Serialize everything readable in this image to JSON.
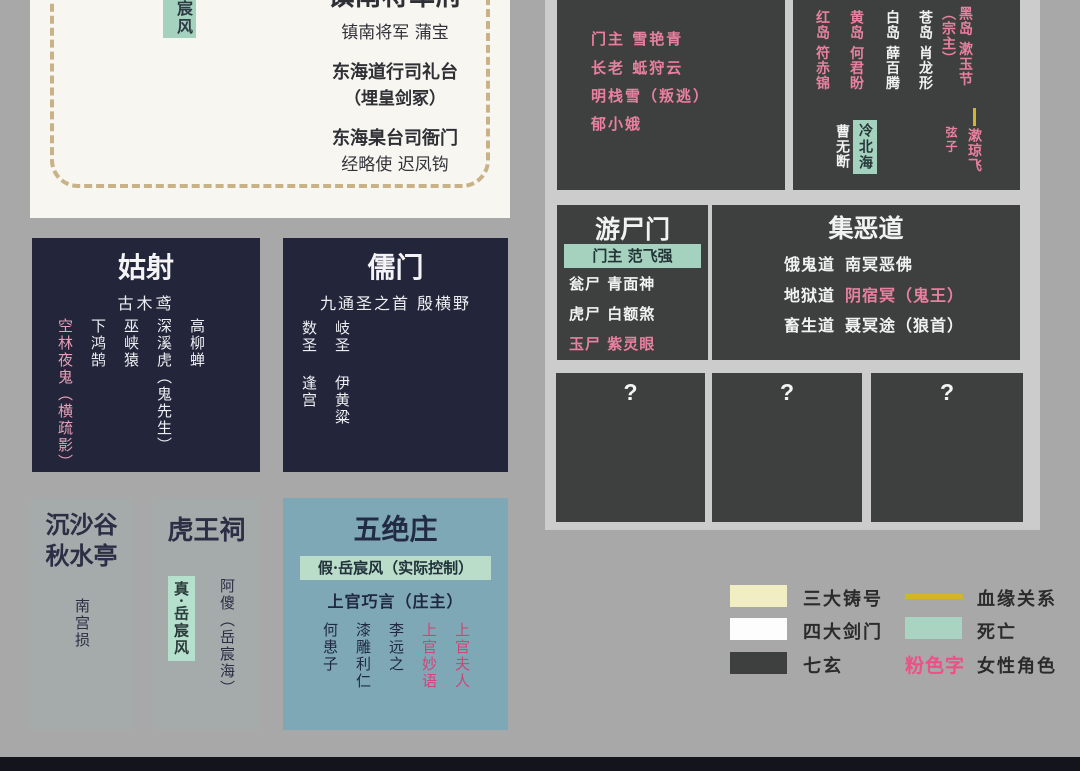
{
  "general_house": {
    "tag": "岳宸风",
    "title": "镇南将军府",
    "subtitle": "镇南将军  蒲宝",
    "entry2_title": "东海道行司礼台",
    "entry2_sub": "（埋皇剑冢）",
    "entry3_title": "东海臬台司衙门",
    "entry3_sub": "经略使  迟凤钩"
  },
  "haisha": {
    "title": "海沙会",
    "members": [
      "门主  雪艳青",
      "长老  蚳狩云",
      "明栈雪（叛逃）",
      "郁小娥"
    ]
  },
  "islands": {
    "columns": [
      "红岛 符赤锦",
      "黄岛 何君盼",
      "白岛 薛百腾",
      "苍岛 肖龙形",
      "黑岛 漱玉节（宗主）"
    ],
    "relation_label": "弦子",
    "descendant": "漱琼飞",
    "deceased": "冷北海",
    "extra": "曹无断"
  },
  "youshimen": {
    "title": "游尸门",
    "leader_line": "门主  范飞强",
    "members": [
      "瓮尸  青面神",
      "虎尸  白额煞",
      "玉尸  紫灵眼"
    ]
  },
  "jiedao": {
    "title": "集恶道",
    "rows": [
      {
        "prefix": "饿鬼道",
        "name": "南冥恶佛"
      },
      {
        "prefix": "地狱道",
        "name": "阴宿冥（鬼王）"
      },
      {
        "prefix": "畜生道",
        "name": "聂冥途（狼首）"
      }
    ]
  },
  "unknown_boxes": [
    "?",
    "?",
    "?"
  ],
  "gushe": {
    "title": "姑射",
    "leader": "古木鸢",
    "columns": [
      "高柳蝉",
      "深溪虎（鬼先生）",
      "巫峡猿",
      "下鸿鹄",
      "空林夜鬼（横疏影）"
    ]
  },
  "rumen": {
    "title": "儒门",
    "leader_line": "九通圣之首  殷横野",
    "columns": [
      {
        "role": "岐圣",
        "name": "伊黄粱"
      },
      {
        "role": "数圣",
        "name": "逢宫"
      }
    ]
  },
  "chensha": {
    "title_line1": "沉沙谷",
    "title_line2": "秋水亭",
    "member": "南宫损"
  },
  "huwang": {
    "title": "虎王祠",
    "deceased": "真·岳宸风",
    "member": "阿傻（岳宸海）"
  },
  "wujue": {
    "title": "五绝庄",
    "controller": "假·岳宸风（实际控制）",
    "owner": "上官巧言（庄主）",
    "columns": [
      "上官夫人",
      "上官妙语",
      "李远之",
      "漆雕利仁",
      "何患子"
    ]
  },
  "legend": {
    "left": [
      {
        "label": "三大铸号"
      },
      {
        "label": "四大剑门"
      },
      {
        "label": "七玄"
      }
    ],
    "right": [
      {
        "label": "血缘关系"
      },
      {
        "label": "死亡"
      },
      {
        "label": "女性角色",
        "sample": "粉色字"
      }
    ],
    "colors": {
      "cream": "#f2eec3",
      "white": "#fdfdfd",
      "dark": "#3e4040",
      "blood_line": "#d1b62c",
      "death_green": "#a9d4c2",
      "female_pink": "#ed4f86"
    }
  }
}
